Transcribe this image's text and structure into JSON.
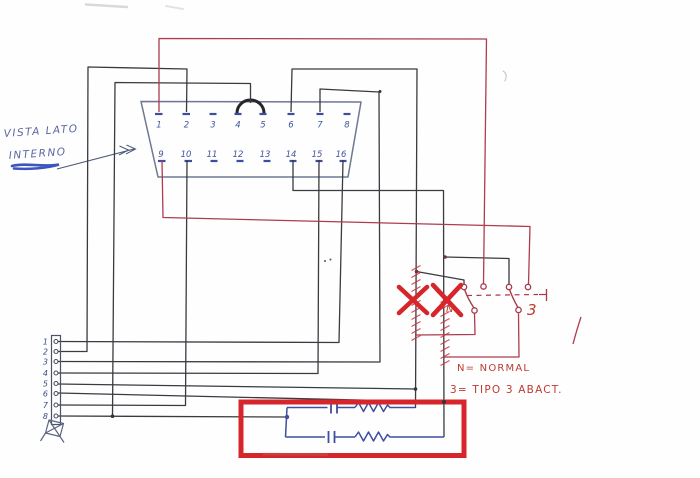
{
  "note": {
    "line1": "VISTA LATO",
    "line2": "INTERNO"
  },
  "connector": {
    "top_pins": [
      "1",
      "2",
      "3",
      "4",
      "5",
      "6",
      "7",
      "8"
    ],
    "bottom_pins": [
      "9",
      "10",
      "11",
      "12",
      "13",
      "14",
      "15",
      "16"
    ]
  },
  "terminal_strip": {
    "labels": [
      "1",
      "2",
      "3",
      "4",
      "5",
      "6",
      "7",
      "8"
    ]
  },
  "switches": {
    "normal_label": "N",
    "type3_label": "3"
  },
  "legend": {
    "line1": "N= NORMAL",
    "line2": "3= TIPO 3 ABACT."
  },
  "colors": {
    "marker_red": "#d6262b",
    "ink_red": "#ae3b4e",
    "ink_blue": "#3d4f9e",
    "note_blue": "#5a68a0",
    "wire_black": "#3a3a41"
  }
}
